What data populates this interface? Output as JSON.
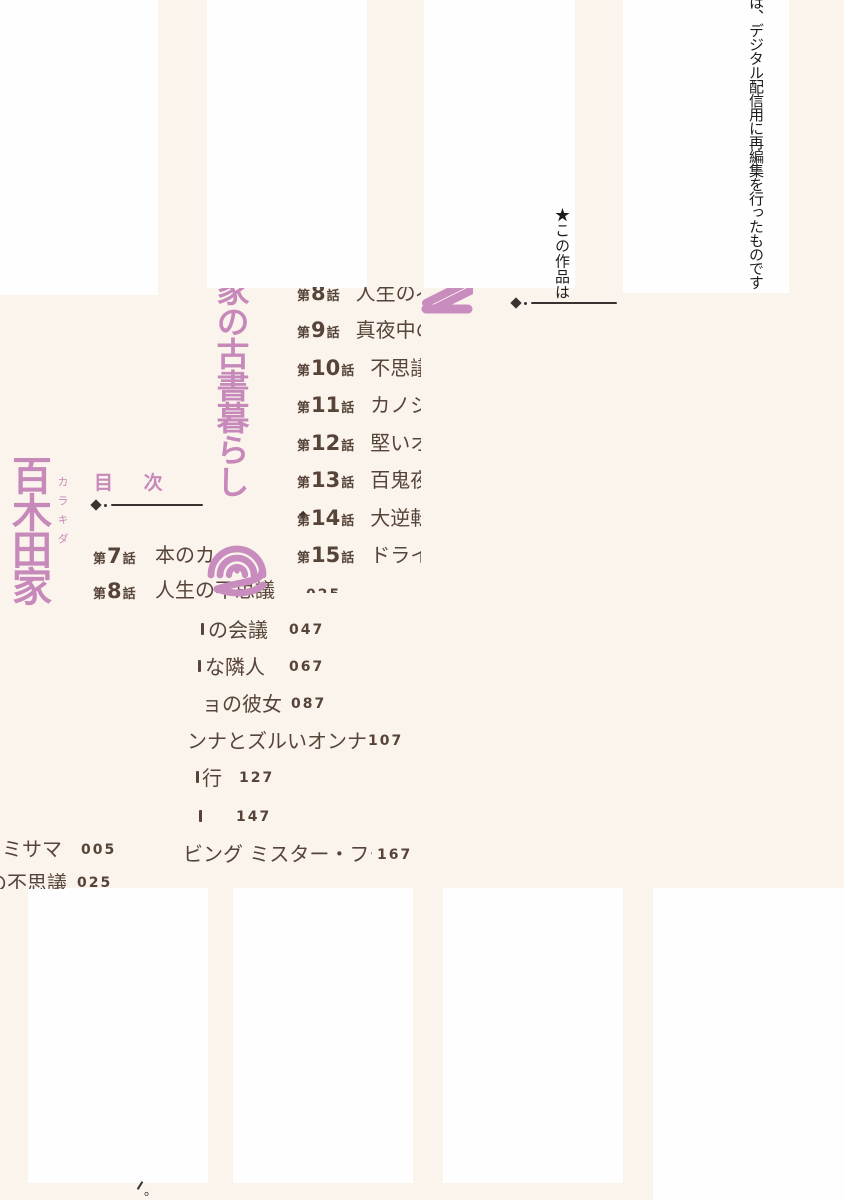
{
  "colors": {
    "page_bg": "#FBF4EC",
    "white_block": "#FEFEFE",
    "pink_accent": "#C689BA",
    "brown_text": "#564439",
    "ink": "#1C1C1C"
  },
  "edition_note": {
    "line_start": "★この作品は",
    "line_end": "は、デジタル配信用に再編集を行ったものです",
    "stray_tail_period": "。"
  },
  "book_title": {
    "main_left_column": "百木田家",
    "furigana": "カラキダ",
    "middle_column_fragment": "家の古書暮らし",
    "volume_glyph": "2"
  },
  "toc": {
    "heading": "目 次",
    "left_list": {
      "row7": {
        "pre": "第",
        "num": "7",
        "post": "話",
        "title": "本のカミサマ",
        "page": "005"
      },
      "row8": {
        "pre": "第",
        "num": "8",
        "post": "話",
        "title": "人生の不思議",
        "page": "025"
      }
    },
    "right_list": {
      "rows": [
        {
          "pre": "第",
          "num": "8",
          "post": "話",
          "title": "人生の不思議"
        },
        {
          "pre": "第",
          "num": "9",
          "post": "話",
          "title": "真夜中の会議"
        },
        {
          "pre": "第",
          "num": "10",
          "post": "話",
          "title": "不思議な隣人"
        },
        {
          "pre": "第",
          "num": "11",
          "post": "話",
          "title": "カノジョの彼女"
        },
        {
          "pre": "第",
          "num": "12",
          "post": "話",
          "title": "堅いオンナとズルいオンナ"
        },
        {
          "pre": "第",
          "num": "13",
          "post": "話",
          "title": "百鬼夜行"
        },
        {
          "pre": "第",
          "num": "14",
          "post": "話",
          "title": "大逆転"
        },
        {
          "pre": "第",
          "num": "15",
          "post": "話",
          "title": "ドライビング ミスター・フー"
        }
      ]
    },
    "fragment_rows_middle": [
      {
        "text": "の会議",
        "page": "047"
      },
      {
        "text": "な隣人",
        "page": "067"
      },
      {
        "text": "ョの彼女",
        "page": "087"
      },
      {
        "text": "ンナとズルいオンナ",
        "page": "107"
      },
      {
        "text": "行",
        "page": "127"
      },
      {
        "text": "",
        "page": "147"
      },
      {
        "text": "ビング ミスター・フー",
        "page": "167"
      }
    ],
    "fragment_rows_bottom_left": [
      {
        "text": "ミサマ",
        "page": "005"
      },
      {
        "text": "の不思議",
        "page": "025"
      }
    ]
  }
}
